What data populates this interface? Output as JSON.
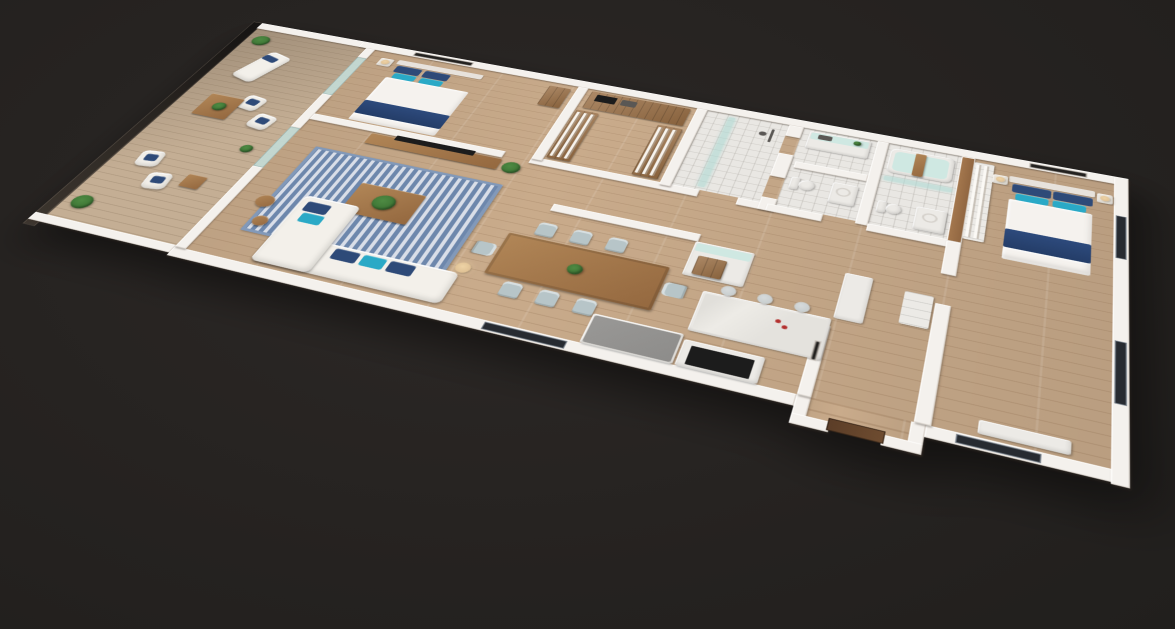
{
  "scene": {
    "type": "3d-floor-plan-render",
    "view": "isometric-perspective",
    "rooms": [
      {
        "name": "balcony",
        "furniture": [
          "glass-railing",
          "lounge-chair",
          "armchairs",
          "coffee-table",
          "side-table",
          "potted-plants"
        ]
      },
      {
        "name": "living-room",
        "furniture": [
          "striped-rug",
          "l-shaped-sofa",
          "coffee-table-with-plant",
          "tv-console",
          "tv",
          "floor-lamp",
          "side-tables",
          "potted-plant"
        ]
      },
      {
        "name": "bedroom-2",
        "furniture": [
          "double-bed",
          "blue-pillows",
          "navy-throw",
          "nightstand",
          "lamp",
          "wall-art",
          "dresser"
        ]
      },
      {
        "name": "walk-in-closet",
        "furniture": [
          "wood-shelving",
          "hanging-clothes",
          "storage-boxes"
        ]
      },
      {
        "name": "shower-room",
        "furniture": [
          "glass-screen",
          "shower-fixture"
        ]
      },
      {
        "name": "hallway",
        "furniture": []
      },
      {
        "name": "dining-room",
        "furniture": [
          "wood-table",
          "eight-chairs",
          "centerpiece-plant"
        ]
      },
      {
        "name": "kitchen",
        "furniture": [
          "island-with-stools",
          "wine-cabinet",
          "tall-cabinet",
          "gray-peninsula",
          "cooktop-counter"
        ]
      },
      {
        "name": "laundry",
        "furniture": [
          "counter-with-sink"
        ]
      },
      {
        "name": "powder-room",
        "furniture": [
          "toilet",
          "round-basin-vanity"
        ]
      },
      {
        "name": "bathroom",
        "furniture": [
          "bathtub",
          "wood-bath-tray",
          "glass-screen",
          "toilet",
          "vanity",
          "wood-accent-wall"
        ]
      },
      {
        "name": "entry",
        "furniture": [
          "front-door",
          "wall-art"
        ]
      },
      {
        "name": "master-bedroom",
        "furniture": [
          "double-bed",
          "blue-pillows",
          "navy-throw",
          "nightstands",
          "lamps",
          "wall-art",
          "wardrobe-shelving",
          "linen-stack",
          "low-dresser",
          "windows"
        ]
      }
    ]
  },
  "palette": {
    "bg": "#252220",
    "bg_light": "#2c2826",
    "wall": "#f4f1ed",
    "wall_shade": "#ddd7d0",
    "floor": "#c9ab8b",
    "balcony_floor": "#c4ae94",
    "tile": "#e9e7e3",
    "window": "#272b31",
    "rug_a": "#6d87ac",
    "rug_b": "#d9dee8",
    "rug_border": "#8299b9",
    "sofa": "#f3f0ea",
    "white_f": "#eceae6",
    "linen": "#f5f2ee",
    "headboard": "#e7e2dc",
    "cushion_navy": "#2e4a78",
    "cushion_teal": "#2aa9c6",
    "throw_navy": "#2d4a7c",
    "wood": "#b18657",
    "wood_dark": "#94683f",
    "closet_wood": "#9a6f45",
    "accent_wood": "#a5784e",
    "chair": "#b7c5c8",
    "stool": "#c2c8c9",
    "counter_gray": "#8d8c8a",
    "black": "#1c1c1c",
    "mint": "#cfe8e2",
    "marble": "#edebe6",
    "plant": "#4e8a43",
    "plant_dark": "#356b2e",
    "door": "#5b3d27",
    "art": "#23211f",
    "lamp": "#d9b98c",
    "red": "#b3302e"
  }
}
